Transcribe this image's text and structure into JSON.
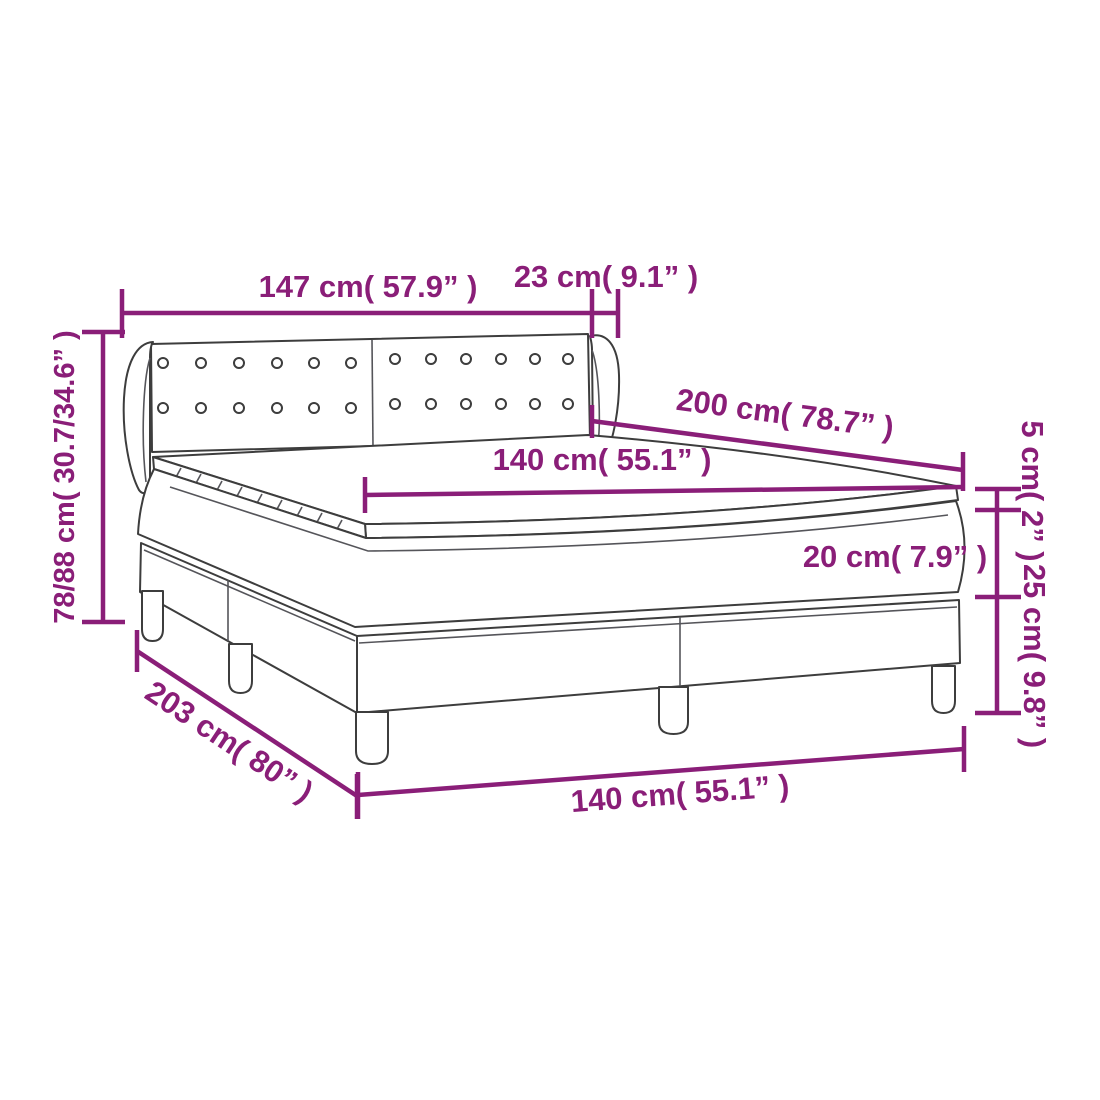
{
  "diagram": {
    "subject": "box spring bed with winged tufted headboard, two-piece base and mattress topper",
    "style": "line drawing with dimension annotations",
    "colors": {
      "dimension_accent": "#8a1e78",
      "drawing_outline": "#3d3d3d",
      "background": "#ffffff"
    },
    "dimensions": {
      "headboard_width": "147 cm( 57.9” )",
      "headboard_wing_depth": "23 cm( 9.1” )",
      "bed_length_top": "200 cm( 78.7” )",
      "mattress_width_top": "140 cm( 55.1” )",
      "total_height": "78/88 cm( 30.7/34.6” )",
      "topper_thickness": "5 cm( 2” )",
      "mattress_thickness": "20 cm( 7.9” )",
      "base_height": "25 cm( 9.8” )",
      "frame_length": "203 cm( 80” )",
      "bed_width_bottom": "140 cm( 55.1” )"
    }
  }
}
